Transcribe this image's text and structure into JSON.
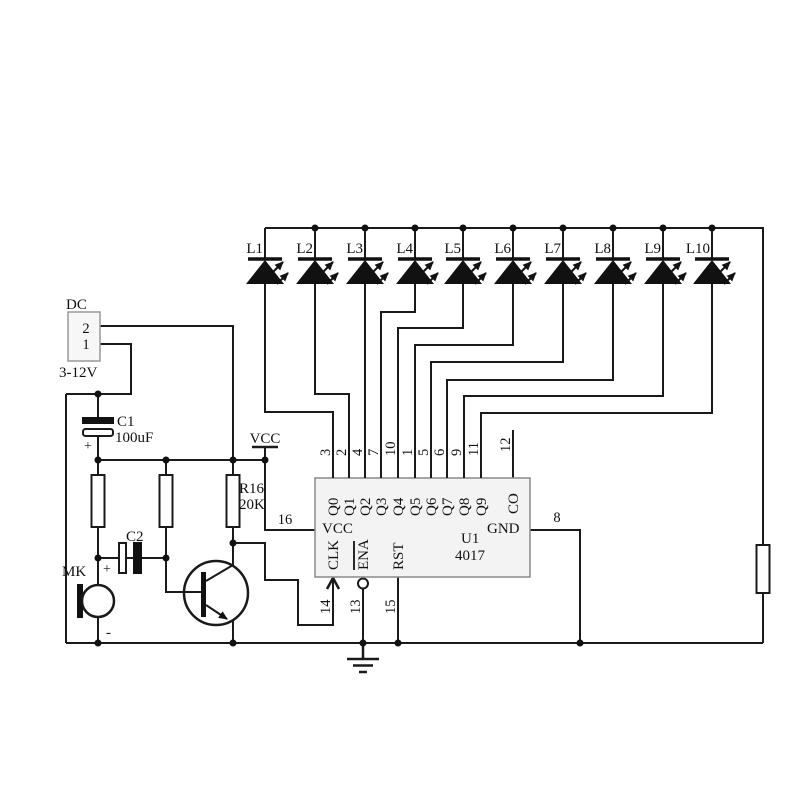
{
  "schematic": {
    "kind": "sound-activated LED chaser circuit",
    "colors": {
      "wire": "#1a1a1a",
      "ic_fill": "#f3f3f3",
      "connector_fill": "#f7f7f7"
    },
    "power_connector": {
      "label": "DC",
      "pin_2": "2",
      "pin_1": "1",
      "voltage_range": "3-12V"
    },
    "c1": {
      "ref": "C1",
      "value": "100uF",
      "polarity_mark": "+"
    },
    "c2": {
      "ref": "C2",
      "polarity_mark": "+"
    },
    "mic": {
      "ref": "MK",
      "polarity_mark": "-"
    },
    "r16": {
      "ref": "R16",
      "value": "20K"
    },
    "vcc_label": "VCC",
    "leds": [
      {
        "ref": "L1"
      },
      {
        "ref": "L2"
      },
      {
        "ref": "L3"
      },
      {
        "ref": "L4"
      },
      {
        "ref": "L5"
      },
      {
        "ref": "L6"
      },
      {
        "ref": "L7"
      },
      {
        "ref": "L8"
      },
      {
        "ref": "L9"
      },
      {
        "ref": "L10"
      }
    ],
    "ic_u1": {
      "ref": "U1",
      "part": "4017",
      "vcc_label": "VCC",
      "clk_label": "CLK",
      "ena_label": "ENA",
      "rst_label": "RST",
      "gnd_label": "GND",
      "outputs": [
        {
          "label": "Q0",
          "pin": "3"
        },
        {
          "label": "Q1",
          "pin": "2"
        },
        {
          "label": "Q2",
          "pin": "4"
        },
        {
          "label": "Q3",
          "pin": "7"
        },
        {
          "label": "Q4",
          "pin": "10"
        },
        {
          "label": "Q5",
          "pin": "1"
        },
        {
          "label": "Q6",
          "pin": "5"
        },
        {
          "label": "Q7",
          "pin": "6"
        },
        {
          "label": "Q8",
          "pin": "9"
        },
        {
          "label": "Q9",
          "pin": "11"
        },
        {
          "label": "CO",
          "pin": "12"
        }
      ],
      "pin_vcc": "16",
      "pin_clk": "14",
      "pin_ena": "13",
      "pin_rst": "15",
      "pin_gnd": "8"
    }
  }
}
